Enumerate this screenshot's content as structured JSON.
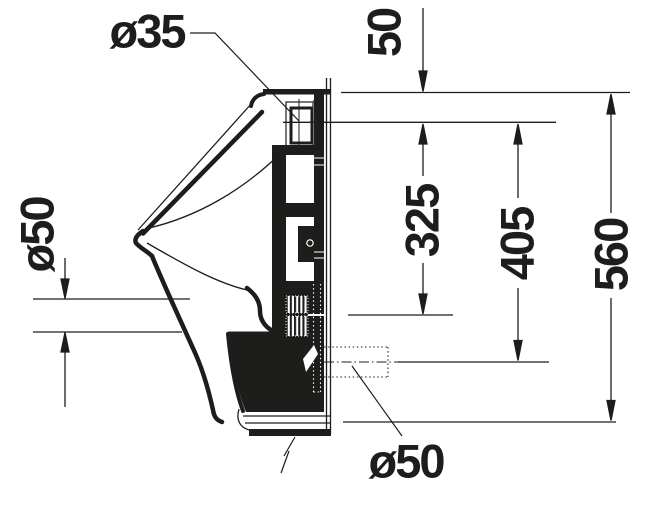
{
  "drawing": {
    "dimensions": {
      "inlet_diameter": "ø35",
      "top_to_inlet": "50",
      "inlet_to_fixing": "325",
      "inlet_to_outlet": "405",
      "overall_height": "560",
      "outlet_diameter_side": "ø50",
      "outlet_diameter_bottom": "ø50"
    },
    "colors": {
      "line": "#1d1d1b",
      "background": "#ffffff"
    }
  }
}
